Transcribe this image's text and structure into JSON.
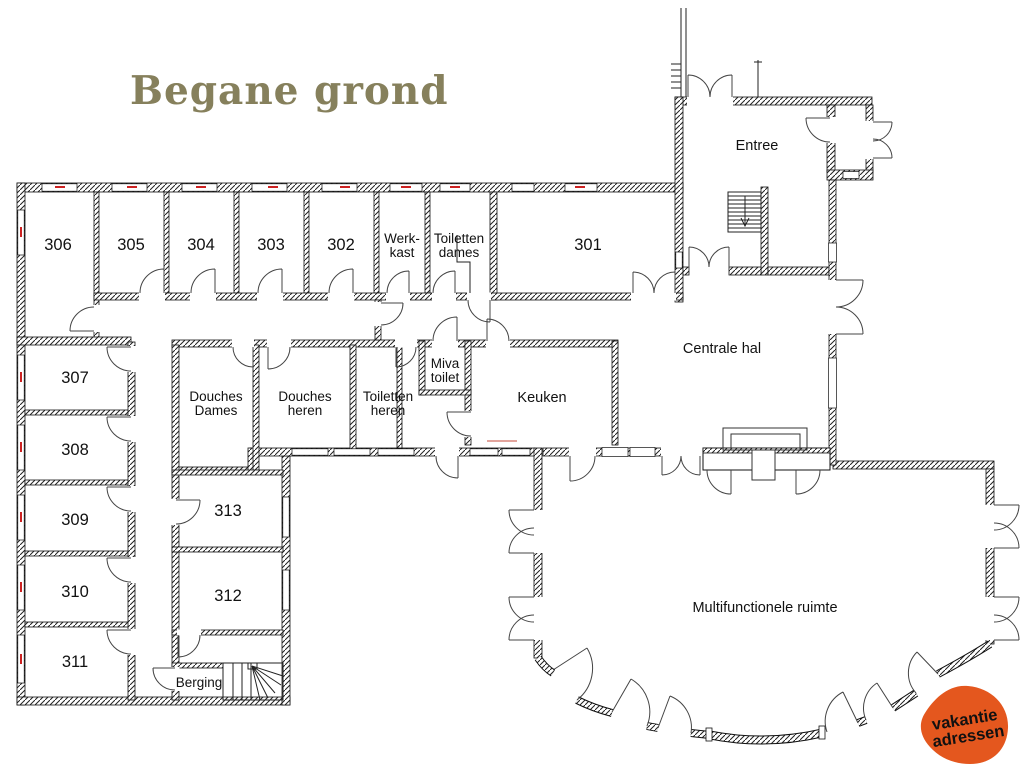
{
  "title": "Begane grond",
  "colors": {
    "title": "#86805c",
    "logo": "#e4571e",
    "window_mark": "#cc2222",
    "highlight": "#e2a49c"
  },
  "logo": {
    "line1": "vakantie",
    "line2": "adressen"
  },
  "rooms": {
    "r301": "301",
    "r302": "302",
    "r303": "303",
    "r304": "304",
    "r305": "305",
    "r306": "306",
    "r307": "307",
    "r308": "308",
    "r309": "309",
    "r310": "310",
    "r311": "311",
    "r312": "312",
    "r313": "313",
    "entree": "Entree",
    "centrale_hal": "Centrale hal",
    "keuken": "Keuken",
    "berging": "Berging",
    "multifunctioneel": "Multifunctionele ruimte",
    "werkkast_l1": "Werk-",
    "werkkast_l2": "kast",
    "toiletten_dames_l1": "Toiletten",
    "toiletten_dames_l2": "dames",
    "douches_dames_l1": "Douches",
    "douches_dames_l2": "Dames",
    "douches_heren_l1": "Douches",
    "douches_heren_l2": "heren",
    "toiletten_heren_l1": "Toiletten",
    "toiletten_heren_l2": "heren",
    "miva_l1": "Miva",
    "miva_l2": "toilet"
  }
}
